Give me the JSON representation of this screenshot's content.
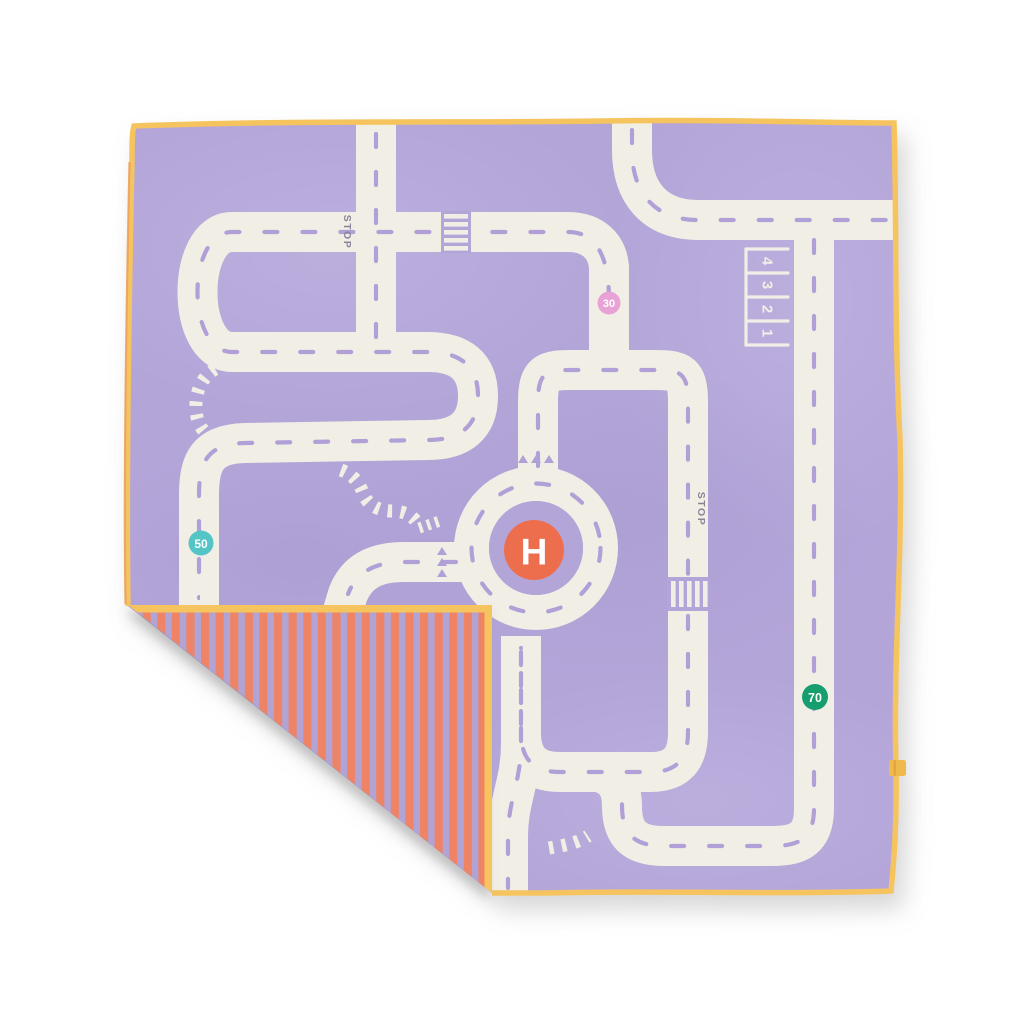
{
  "scene": {
    "description": "Product photo of a square kids play mat printed with a toy road map, bottom-left corner folded over showing a striped reverse side",
    "background_color": "#ffffff"
  },
  "mat": {
    "base_color": "#b4a5d9",
    "road_color": "#f1efe5",
    "dash_color": "#b1a0d7",
    "trim_color": "#f5c45f",
    "trim_accent_color": "#eb9f5b",
    "marking_text_color": "#8d8399"
  },
  "flap": {
    "stripe_color_a": "#ee8366",
    "stripe_color_b": "#b1a4d5",
    "trim_color": "#f5c45f"
  },
  "signs": {
    "helipad": {
      "label": "H",
      "color": "#ed6e4e",
      "text_color": "#ffffff"
    },
    "speed_30": {
      "label": "30",
      "color": "#e9a2d6",
      "text_color": "#ffffff"
    },
    "speed_50": {
      "label": "50",
      "color": "#54c4c7",
      "text_color": "#ffffff"
    },
    "speed_70": {
      "label": "70",
      "color": "#139e6e",
      "text_color": "#ffffff"
    }
  },
  "road_markings": {
    "stop_top": "STOP",
    "stop_right": "STOP",
    "parking_spaces": [
      "1",
      "2",
      "3",
      "4"
    ]
  },
  "tag": {
    "color": "#f0b94e",
    "accent": "#e2a03c"
  }
}
